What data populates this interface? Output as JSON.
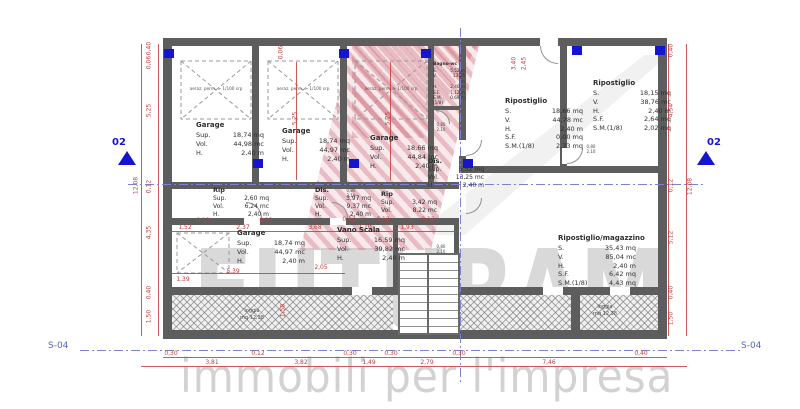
{
  "watermark": {
    "brand": "FUTURAM",
    "tagline": "immobili per l'impresa"
  },
  "markers": {
    "section_id": "02",
    "sheet_id": "S-04"
  },
  "labels": {
    "aeration": "aeraz. perm. > 1/100 srp",
    "door_w": "0,80",
    "door_h": "2,10"
  },
  "rooms": {
    "garage1": {
      "title": "Garage",
      "rows": [
        [
          "Sup.",
          "18,74 mq"
        ],
        [
          "Vol.",
          "44,98 mc"
        ],
        [
          "H.",
          "2,40 m"
        ]
      ]
    },
    "garage2": {
      "title": "Garage",
      "rows": [
        [
          "Sup.",
          "18,74 mq"
        ],
        [
          "Vol.",
          "44,97 mc"
        ],
        [
          "H.",
          "2,40 m"
        ]
      ]
    },
    "garage3": {
      "title": "Garage",
      "rows": [
        [
          "Sup.",
          "18,66 mq"
        ],
        [
          "Vol.",
          "44,84 mc"
        ],
        [
          "H.",
          "2,40 m"
        ]
      ]
    },
    "garage4": {
      "title": "Garage",
      "rows": [
        [
          "Sup.",
          "18,74 mq"
        ],
        [
          "Vol.",
          "44,97 mc"
        ],
        [
          "H.",
          "2,40 m"
        ]
      ]
    },
    "bagno": {
      "title": "Bagno-wc",
      "rows": [
        [
          "S.",
          "5,52 m"
        ],
        [
          "V.",
          "13,25 m"
        ],
        [
          "H.",
          "2,40 m"
        ],
        [
          "S.F.",
          "1,12 m"
        ],
        [
          "S.M.(1/8)",
          "0,69 m"
        ]
      ]
    },
    "rip_small": {
      "title": "Rip",
      "rows": [
        [
          "Sup.",
          "2,60 mq"
        ],
        [
          "Vol.",
          "6,24 mc"
        ],
        [
          "H.",
          "2,40 m"
        ]
      ]
    },
    "dis_small": {
      "title": "Dis.",
      "rows": [
        [
          "Sup.",
          "3,97 mq"
        ],
        [
          "Vol.",
          "9,37 mc"
        ],
        [
          "H.",
          "2,40 m"
        ]
      ]
    },
    "dis_center": {
      "title": "Dis.",
      "rows": [
        [
          "Sup.",
          "5,52 mq"
        ],
        [
          "Vol.",
          "13,25 mc"
        ],
        [
          "H.",
          "2,40 m"
        ]
      ]
    },
    "rip_center": {
      "title": "Rip",
      "rows": [
        [
          "Sup.",
          "3,42 mq"
        ],
        [
          "Vol.",
          "8,22 mc"
        ]
      ]
    },
    "rip_a": {
      "title": "Ripostiglio",
      "rows": [
        [
          "S.",
          "18,66 mq"
        ],
        [
          "V.",
          "44,78 mc"
        ],
        [
          "H.",
          "2,40 m"
        ],
        [
          "S.F.",
          "0,00 mq"
        ],
        [
          "S.M.(1/8)",
          "2,33 mq"
        ]
      ]
    },
    "rip_b": {
      "title": "Ripostiglio",
      "rows": [
        [
          "S.",
          "18,15 mq"
        ],
        [
          "V.",
          "38,76 mc"
        ],
        [
          "H.",
          "2,40 m"
        ],
        [
          "S.F.",
          "2,64 mq"
        ],
        [
          "S.M.(1/8)",
          "2,02 mq"
        ]
      ]
    },
    "vano_scala": {
      "title": "Vano Scala",
      "rows": [
        [
          "Sup.",
          "16,59 mq"
        ],
        [
          "Vol.",
          "39,82 mc"
        ],
        [
          "H.",
          "2,40 m"
        ]
      ]
    },
    "magazzino": {
      "title": "Ripostiglio/magazzino",
      "rows": [
        [
          "S.",
          "35,43 mq"
        ],
        [
          "V.",
          "85,04 mc"
        ],
        [
          "H.",
          "2,40 m"
        ],
        [
          "S.F.",
          "6,42 mq"
        ],
        [
          "S.M.(1/8)",
          "4,43 mq"
        ]
      ]
    },
    "loggia_left": {
      "title": "loggia",
      "area": "mq 12,38"
    },
    "loggia_right": {
      "title": "loggia",
      "area": "mq 12,38"
    }
  },
  "dims": {
    "left_overall": "12,08",
    "right_overall": "12,08",
    "left_col": [
      "0,40",
      "0,06",
      "5,25",
      "0,12",
      "4,35",
      "0,40",
      "1,50"
    ],
    "right_col": [
      "0,40",
      "4,54",
      "0,12",
      "5,12",
      "0,40",
      "1,50"
    ],
    "bottom_row1": [
      "0,30",
      "0,12",
      "0,30",
      "0,30",
      "0,30",
      "0,40"
    ],
    "bottom_row2": [
      "3,81",
      "3,82",
      "1,49",
      "2,79",
      "7,46"
    ],
    "inner_h": [
      "1,52",
      "2,37",
      "3,68",
      "0,12",
      "0,12",
      "0,12",
      "0,12",
      "0,12",
      "1,10",
      "1,93",
      "5,39",
      "2,05",
      "1,39"
    ],
    "inner_v": [
      "1,50",
      "5,25",
      "5,25",
      "0,06",
      "3,40",
      "2,45"
    ]
  },
  "colors": {
    "dim_red": "#c23a3a",
    "marker_blue": "#1515d0",
    "wall_gray": "#5d5d5d",
    "logo_pink": "#c85064",
    "watermark_gray": "#d9d9d9"
  }
}
